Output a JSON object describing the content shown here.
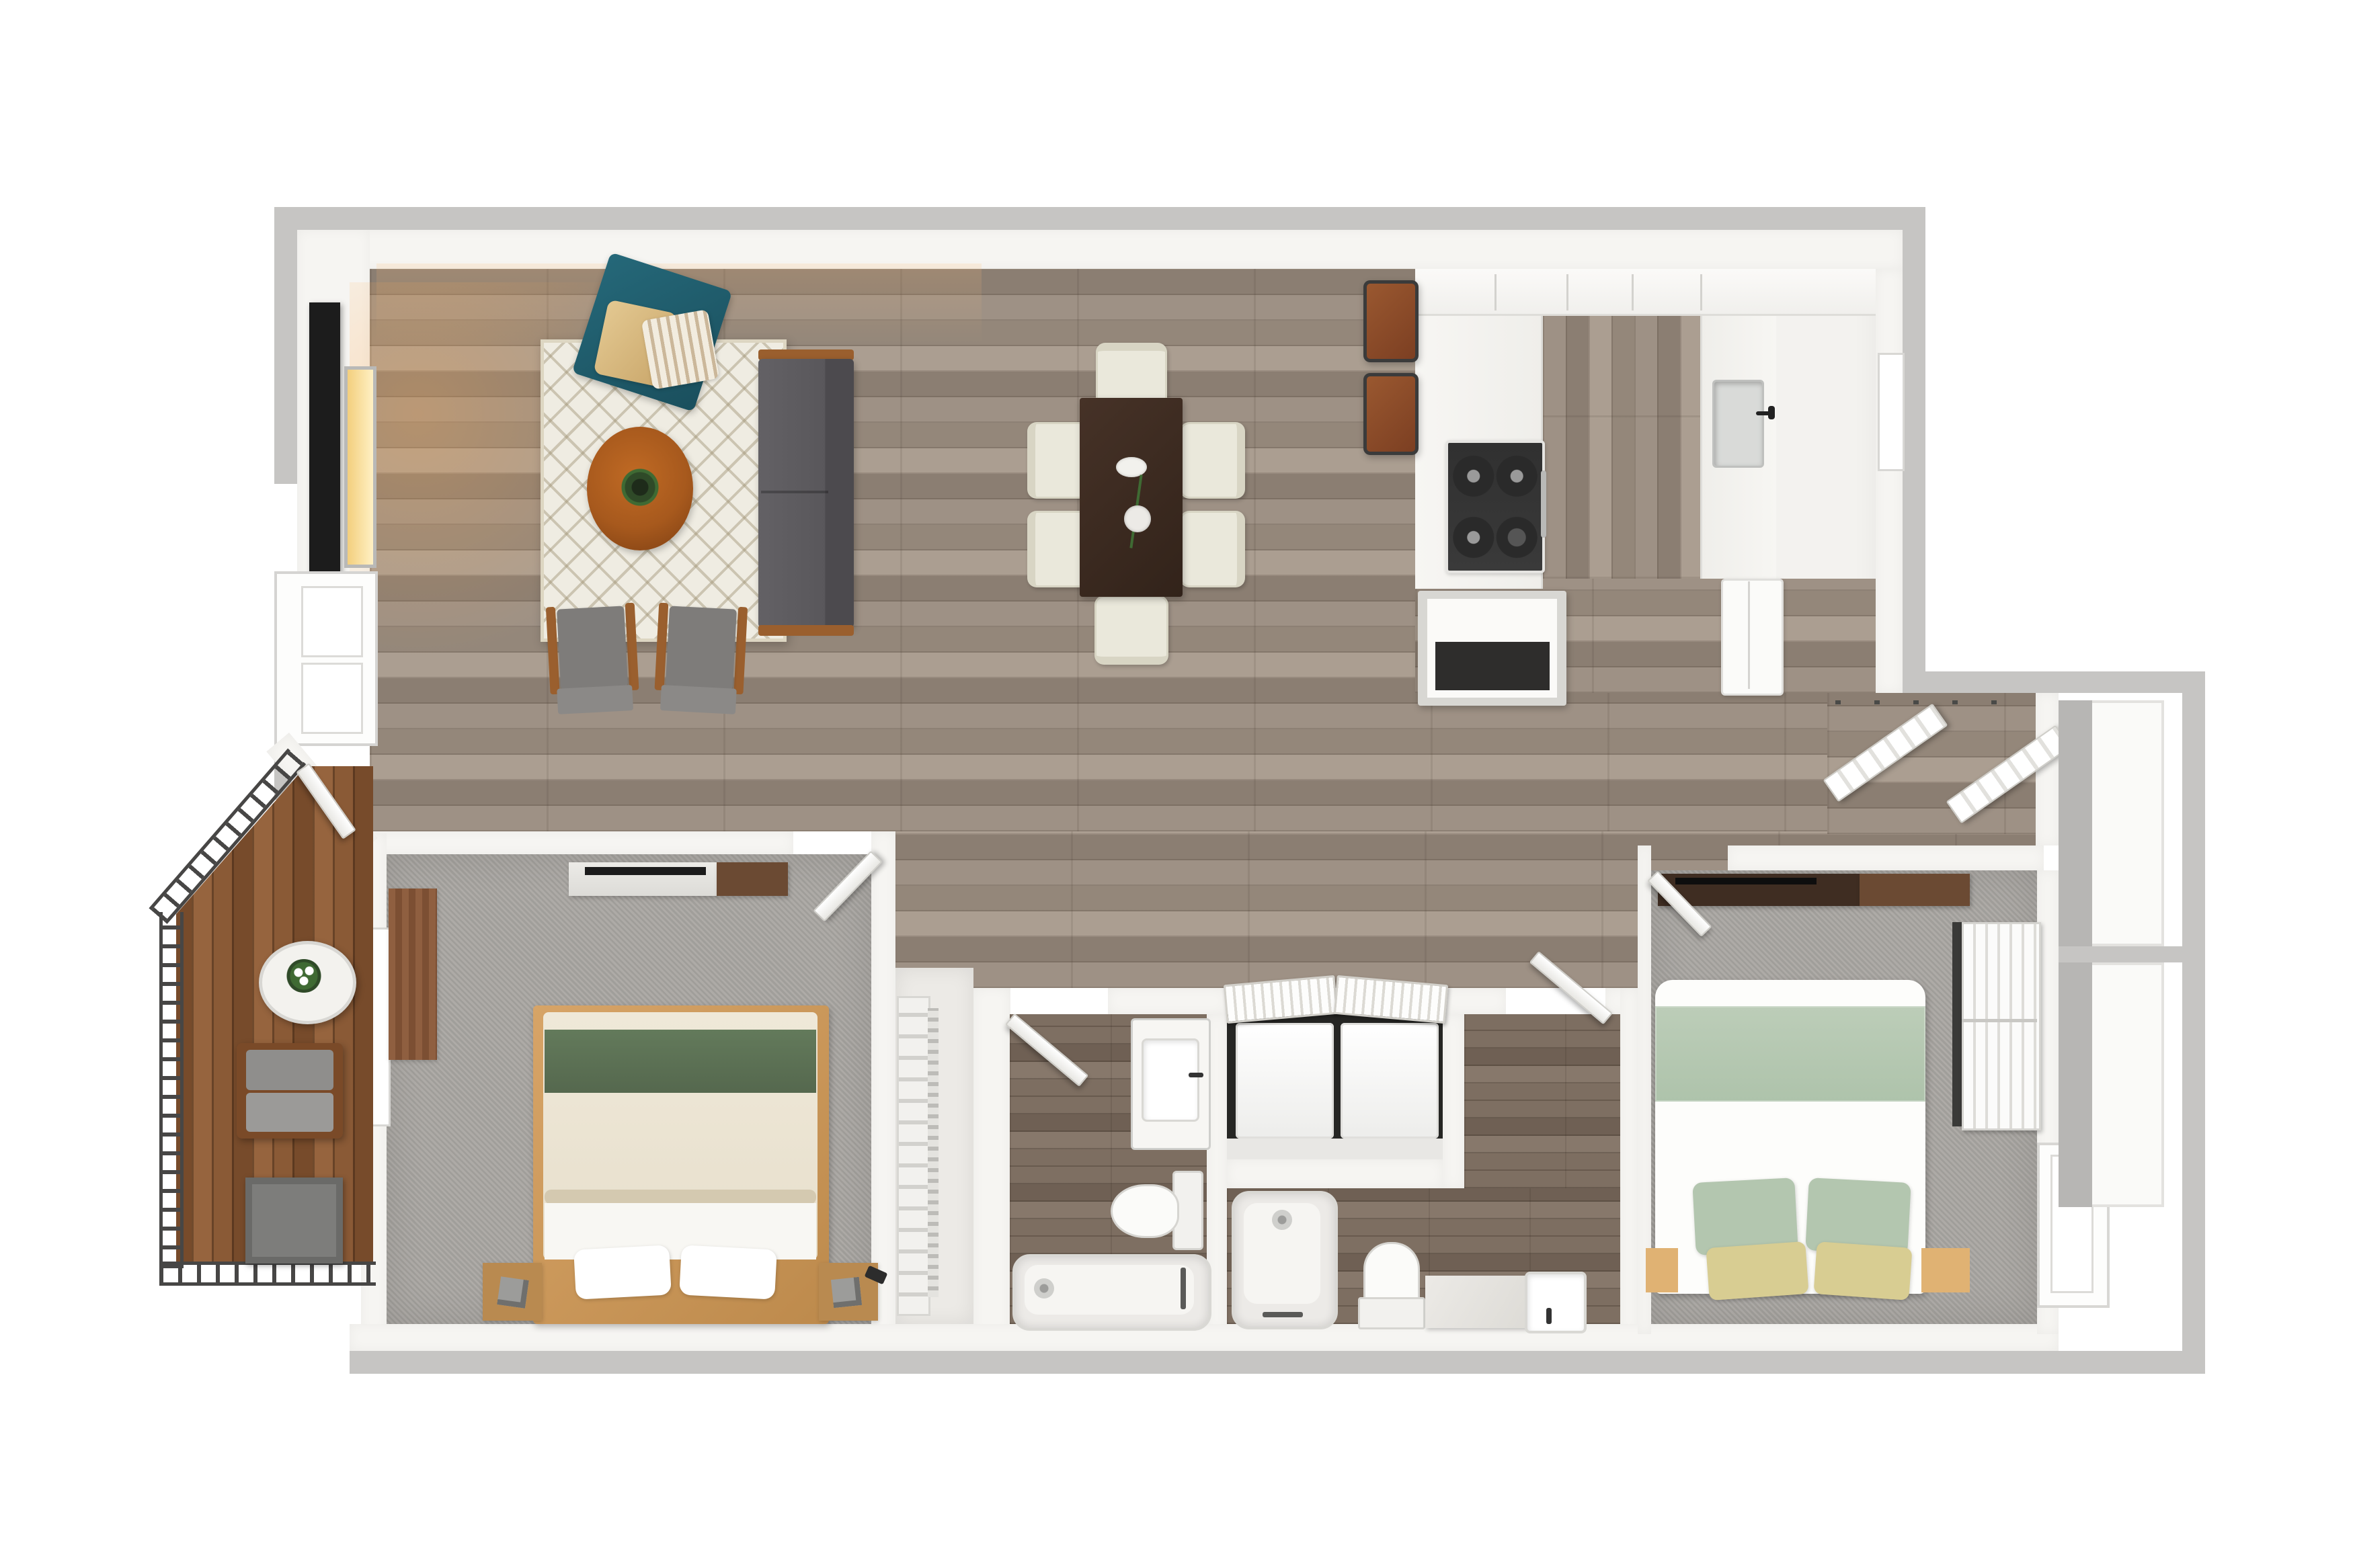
{
  "meta": {
    "image_type": "3d-rendered apartment floor plan, top-down view",
    "text_labels": [],
    "layout_summary": "Open living/dining/kitchen across the top; balcony with wood deck lower-left; master bedroom, walk-in closet, bathroom, laundry closet, second bathroom and second bedroom across the bottom; entry closet with bifold doors and exterior storage cabinets on the right."
  },
  "palette": {
    "border_gray": "#c6c5c3",
    "wall": "#f6f5f2",
    "floor_wood": "#9e9185",
    "floor_wood_dark": "#8b7e72",
    "floor_wood_light": "#ab9e91",
    "marble": "#f3f2ef",
    "carpet": "#a9a6a2",
    "bath_floor": "#7e6f62",
    "laundry_dark": "#262624",
    "deck": "#8a5a36",
    "deck_dark": "#774b2b",
    "railing": "#474645",
    "rug": "#efece2",
    "teal": "#1f5a6a",
    "sofa": "#5b595d",
    "wood_accent": "#9a5f2e",
    "table_wood": "#a7591d",
    "dining_table": "#3a2a21",
    "cream": "#eae8db",
    "stool": "#8a4a28",
    "steel": "#d9dad8",
    "bed_wood": "#cd9a5e",
    "duvet": "#ece4d2",
    "green": "#5d7355",
    "sage": "#b7c9b3",
    "yellow": "#d8cd92",
    "tv": "#1c1c1c",
    "glow": "#f7d98b",
    "appliance": "#fbfbf9",
    "cabinet_gray": "#b7b6b4",
    "fixture": "#ececea",
    "fixture_line": "#cfcfcc",
    "brown_art": "#8a5a3c",
    "dresser_dark": "#3f2d22",
    "dresser_mid": "#6b4a33"
  },
  "rooms": [
    {
      "name": "living-room",
      "floor": "wood-plank",
      "items": [
        "quatrefoil-rug",
        "teal-armchair",
        "tan-pillow",
        "striped-pillow",
        "gray-sofa",
        "oval-coffee-table",
        "potted-plant",
        "accent-chair-left",
        "accent-chair-right",
        "tv-panel",
        "wall-lamp",
        "west-window"
      ]
    },
    {
      "name": "dining-area",
      "floor": "wood-plank",
      "items": [
        "rectangular-dark-table",
        "flower-vase",
        "six-cream-chairs"
      ]
    },
    {
      "name": "kitchen",
      "floor": "marble-and-wood",
      "items": [
        "u-shaped-counter",
        "gas-cooktop",
        "sink-with-faucet",
        "kitchen-window",
        "island-with-open-shelf",
        "refrigerator",
        "two-bar-stools"
      ]
    },
    {
      "name": "entry-nook",
      "floor": "wood-plank",
      "items": [
        "bifold-double-doors"
      ]
    },
    {
      "name": "exterior-storage",
      "items": [
        "upper-cabinet",
        "lower-cabinet"
      ]
    },
    {
      "name": "master-bedroom",
      "floor": "carpet",
      "items": [
        "platform-bed",
        "green-blanket-band",
        "two-white-pillows",
        "two-nightstands",
        "tv-console",
        "dresser",
        "west-window",
        "brown-wall-art",
        "swing-door"
      ]
    },
    {
      "name": "walk-in-closet",
      "items": [
        "shelving-with-clothes"
      ]
    },
    {
      "name": "bathroom-1",
      "floor": "wood-tile",
      "items": [
        "vanity-sink",
        "toilet",
        "bathtub",
        "swing-door"
      ]
    },
    {
      "name": "laundry-closet",
      "items": [
        "washer",
        "dryer",
        "louvered-bifold-doors"
      ]
    },
    {
      "name": "bathroom-2",
      "floor": "wood-tile",
      "items": [
        "vertical-bathtub",
        "toilet",
        "marble-vanity-with-sink",
        "swing-door"
      ]
    },
    {
      "name": "bedroom-2",
      "floor": "carpet",
      "items": [
        "bed-with-sage-bedding",
        "two-sage-pillows",
        "two-yellow-pillows",
        "dresser-with-tv",
        "sliding-closet-doors",
        "east-window",
        "swing-door"
      ]
    },
    {
      "name": "balcony",
      "floor": "wood-deck",
      "items": [
        "slatted-railing",
        "oval-patio-table",
        "flower-bouquet",
        "gray-patio-chair",
        "storage-box",
        "balcony-door"
      ]
    }
  ]
}
